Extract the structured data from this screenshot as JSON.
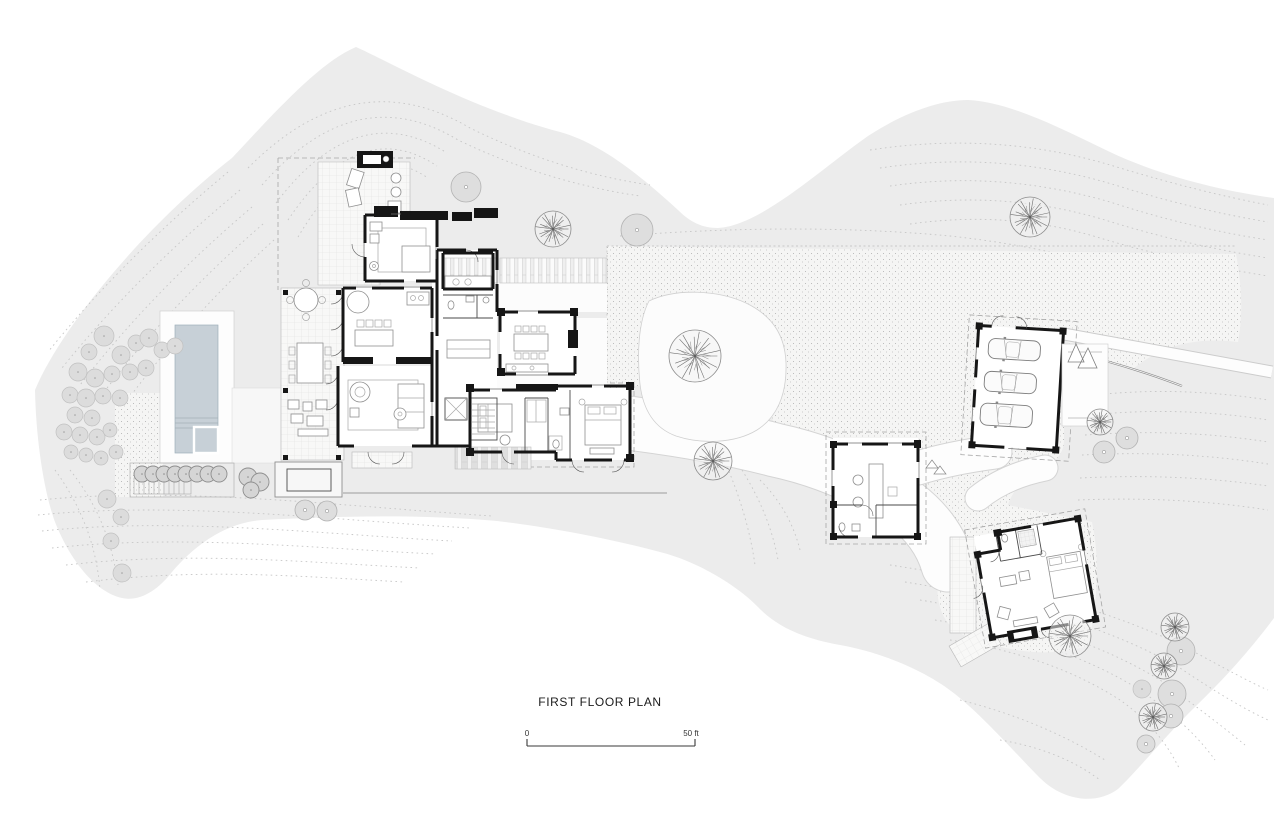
{
  "document": {
    "type": "architectural-floor-plan",
    "title": "FIRST FLOOR PLAN"
  },
  "scale_bar": {
    "start_label": "0",
    "end_label": "50 ft",
    "length_ft": 50
  },
  "palette": {
    "paper": "#ffffff",
    "site_fill": "#ececec",
    "contour_line": "#c6c6c6",
    "stipple_bg": "#f5f5f4",
    "stipple_dot": "#ababab",
    "path_white": "#fdfdfd",
    "wall_black": "#161616",
    "pool_water": "#c7d0d7",
    "tree_dark_line": "#6e6e6e",
    "tree_light_fill": "#dedede",
    "shrub_fill": "#dcdcdc",
    "hedge_fill": "#d5d5d5"
  },
  "landscape": {
    "trees_branching": [
      {
        "x": 553,
        "y": 229,
        "r": 18
      },
      {
        "x": 1030,
        "y": 217,
        "r": 20
      },
      {
        "x": 695,
        "y": 356,
        "r": 26
      },
      {
        "x": 713,
        "y": 461,
        "r": 19
      },
      {
        "x": 1100,
        "y": 422,
        "r": 13
      },
      {
        "x": 1070,
        "y": 636,
        "r": 21
      },
      {
        "x": 1175,
        "y": 627,
        "r": 14
      },
      {
        "x": 1164,
        "y": 666,
        "r": 13
      },
      {
        "x": 1153,
        "y": 717,
        "r": 14
      }
    ],
    "trees_round": [
      {
        "x": 466,
        "y": 187,
        "r": 15
      },
      {
        "x": 637,
        "y": 230,
        "r": 16
      },
      {
        "x": 1127,
        "y": 438,
        "r": 11
      },
      {
        "x": 1104,
        "y": 452,
        "r": 11
      },
      {
        "x": 1181,
        "y": 651,
        "r": 14
      },
      {
        "x": 1172,
        "y": 694,
        "r": 14
      },
      {
        "x": 1171,
        "y": 716,
        "r": 12
      },
      {
        "x": 305,
        "y": 510,
        "r": 10
      },
      {
        "x": 327,
        "y": 511,
        "r": 10
      },
      {
        "x": 1146,
        "y": 744,
        "r": 9
      }
    ],
    "shrubs": [
      {
        "x": 104,
        "y": 336,
        "r": 10
      },
      {
        "x": 89,
        "y": 352,
        "r": 8
      },
      {
        "x": 121,
        "y": 355,
        "r": 9
      },
      {
        "x": 136,
        "y": 343,
        "r": 8
      },
      {
        "x": 149,
        "y": 338,
        "r": 9
      },
      {
        "x": 162,
        "y": 350,
        "r": 8
      },
      {
        "x": 175,
        "y": 346,
        "r": 8
      },
      {
        "x": 78,
        "y": 372,
        "r": 9
      },
      {
        "x": 95,
        "y": 378,
        "r": 9
      },
      {
        "x": 112,
        "y": 374,
        "r": 8
      },
      {
        "x": 130,
        "y": 372,
        "r": 8
      },
      {
        "x": 146,
        "y": 368,
        "r": 8
      },
      {
        "x": 70,
        "y": 395,
        "r": 8
      },
      {
        "x": 86,
        "y": 398,
        "r": 9
      },
      {
        "x": 103,
        "y": 396,
        "r": 8
      },
      {
        "x": 120,
        "y": 398,
        "r": 8
      },
      {
        "x": 75,
        "y": 415,
        "r": 8
      },
      {
        "x": 92,
        "y": 418,
        "r": 8
      },
      {
        "x": 64,
        "y": 432,
        "r": 8
      },
      {
        "x": 80,
        "y": 435,
        "r": 8
      },
      {
        "x": 97,
        "y": 437,
        "r": 8
      },
      {
        "x": 110,
        "y": 430,
        "r": 7
      },
      {
        "x": 71,
        "y": 452,
        "r": 7
      },
      {
        "x": 86,
        "y": 455,
        "r": 7
      },
      {
        "x": 101,
        "y": 458,
        "r": 7
      },
      {
        "x": 116,
        "y": 452,
        "r": 7
      },
      {
        "x": 107,
        "y": 499,
        "r": 9
      },
      {
        "x": 121,
        "y": 517,
        "r": 8
      },
      {
        "x": 111,
        "y": 541,
        "r": 8
      },
      {
        "x": 122,
        "y": 573,
        "r": 9
      },
      {
        "x": 1142,
        "y": 689,
        "r": 9
      }
    ],
    "hedge_row": [
      {
        "x": 142,
        "y": 474,
        "r": 8
      },
      {
        "x": 153,
        "y": 474,
        "r": 8
      },
      {
        "x": 164,
        "y": 474,
        "r": 8
      },
      {
        "x": 175,
        "y": 474,
        "r": 8
      },
      {
        "x": 186,
        "y": 474,
        "r": 8
      },
      {
        "x": 197,
        "y": 474,
        "r": 8
      },
      {
        "x": 208,
        "y": 474,
        "r": 8
      },
      {
        "x": 219,
        "y": 474,
        "r": 8
      },
      {
        "x": 248,
        "y": 477,
        "r": 9
      },
      {
        "x": 260,
        "y": 482,
        "r": 9
      },
      {
        "x": 251,
        "y": 490,
        "r": 8
      }
    ]
  },
  "garage": {
    "cars": [
      {
        "x": 986,
        "y": 340,
        "w": 52,
        "h": 20
      },
      {
        "x": 984,
        "y": 373,
        "w": 52,
        "h": 20
      },
      {
        "x": 982,
        "y": 405,
        "w": 52,
        "h": 22
      }
    ]
  }
}
